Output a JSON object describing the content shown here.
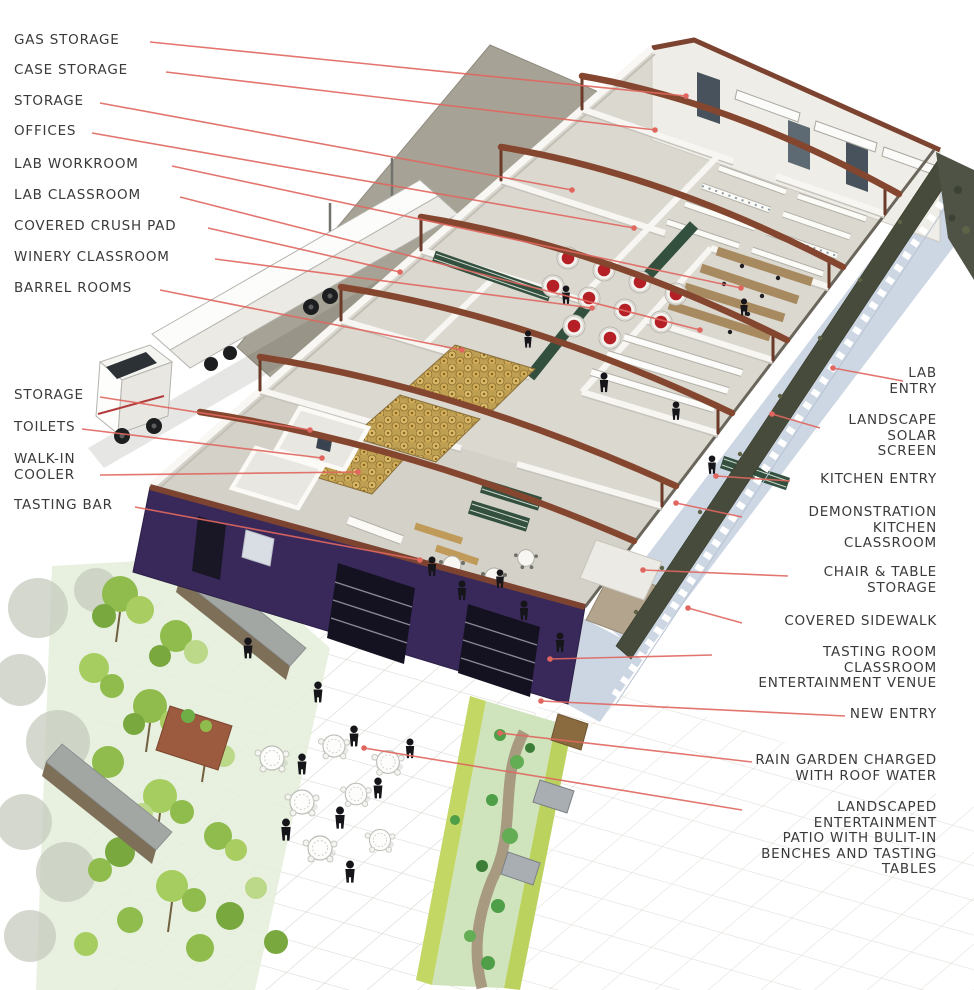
{
  "diagram": {
    "type": "architectural-cutaway-axonometric",
    "subject": "winery and culinary education building with labeled program areas"
  },
  "colors": {
    "leader": "#e0675f",
    "label_text": "#3a3a3a",
    "purple_wall": "#39295a",
    "beam_brown": "#84462e",
    "roof_trim": "#7c4430",
    "crush_pad_gray": "#a6a295",
    "sidewalk_blue": "#cdd7e4",
    "solar_screen": "#474b3c",
    "tank_top_red": "#b42026",
    "barrel_gold": "#c9a85c",
    "wine_rack_green": "#33503f",
    "tree_green": "#8fbc4d",
    "rain_garden_green": "#cfe3bd",
    "floor_gray": "#dbd8d0"
  },
  "left_labels": [
    {
      "id": "gas-storage",
      "lines": [
        "GAS STORAGE"
      ],
      "x": 14,
      "y": 33,
      "from": [
        150,
        42
      ],
      "to": [
        686,
        96
      ]
    },
    {
      "id": "case-storage",
      "lines": [
        "CASE STORAGE"
      ],
      "x": 14,
      "y": 63,
      "from": [
        166,
        72
      ],
      "to": [
        655,
        130
      ]
    },
    {
      "id": "storage-upper",
      "lines": [
        "STORAGE"
      ],
      "x": 14,
      "y": 94,
      "from": [
        100,
        103
      ],
      "to": [
        572,
        190
      ]
    },
    {
      "id": "offices",
      "lines": [
        "OFFICES"
      ],
      "x": 14,
      "y": 124,
      "from": [
        92,
        133
      ],
      "to": [
        634,
        228
      ]
    },
    {
      "id": "lab-workroom",
      "lines": [
        "LAB WORKROOM"
      ],
      "x": 14,
      "y": 157,
      "from": [
        172,
        166
      ],
      "to": [
        741,
        288
      ]
    },
    {
      "id": "lab-classroom",
      "lines": [
        "LAB CLASSROOM"
      ],
      "x": 14,
      "y": 188,
      "from": [
        180,
        197
      ],
      "to": [
        700,
        330
      ]
    },
    {
      "id": "covered-crush-pad",
      "lines": [
        "COVERED CRUSH PAD"
      ],
      "x": 14,
      "y": 219,
      "from": [
        208,
        228
      ],
      "to": [
        400,
        272
      ]
    },
    {
      "id": "winery-classroom",
      "lines": [
        "WINERY CLASSROOM"
      ],
      "x": 14,
      "y": 250,
      "from": [
        215,
        259
      ],
      "to": [
        592,
        308
      ]
    },
    {
      "id": "barrel-rooms",
      "lines": [
        "BARREL ROOMS"
      ],
      "x": 14,
      "y": 281,
      "from": [
        160,
        290
      ],
      "to": [
        462,
        350
      ]
    },
    {
      "id": "storage-lower",
      "lines": [
        "STORAGE"
      ],
      "x": 14,
      "y": 388,
      "from": [
        100,
        397
      ],
      "to": [
        310,
        430
      ]
    },
    {
      "id": "toilets",
      "lines": [
        "TOILETS"
      ],
      "x": 14,
      "y": 420,
      "from": [
        82,
        429
      ],
      "to": [
        322,
        458
      ]
    },
    {
      "id": "walk-in-cooler",
      "lines": [
        "WALK-IN",
        "COOLER"
      ],
      "x": 14,
      "y": 452,
      "from": [
        100,
        475
      ],
      "to": [
        358,
        472
      ]
    },
    {
      "id": "tasting-bar",
      "lines": [
        "TASTING BAR"
      ],
      "x": 14,
      "y": 498,
      "from": [
        135,
        507
      ],
      "to": [
        420,
        560
      ]
    }
  ],
  "right_labels": [
    {
      "id": "lab-entry",
      "lines": [
        "LAB",
        "ENTRY"
      ],
      "xr": 937,
      "y": 366,
      "from": [
        903,
        381
      ],
      "to": [
        833,
        368
      ]
    },
    {
      "id": "landscape-solar-screen",
      "lines": [
        "LANDSCAPE",
        "SOLAR",
        "SCREEN"
      ],
      "xr": 937,
      "y": 413,
      "from": [
        820,
        428
      ],
      "to": [
        772,
        414
      ]
    },
    {
      "id": "kitchen-entry",
      "lines": [
        "KITCHEN ENTRY"
      ],
      "xr": 937,
      "y": 472,
      "from": [
        790,
        481
      ],
      "to": [
        716,
        476
      ]
    },
    {
      "id": "demonstration-kitchen-classroom",
      "lines": [
        "DEMONSTRATION",
        "KITCHEN",
        "CLASSROOM"
      ],
      "xr": 937,
      "y": 505,
      "from": [
        742,
        517
      ],
      "to": [
        676,
        503
      ]
    },
    {
      "id": "chair-table-storage",
      "lines": [
        "CHAIR & TABLE",
        "STORAGE"
      ],
      "xr": 937,
      "y": 565,
      "from": [
        788,
        576
      ],
      "to": [
        643,
        570
      ]
    },
    {
      "id": "covered-sidewalk",
      "lines": [
        "COVERED SIDEWALK"
      ],
      "xr": 937,
      "y": 614,
      "from": [
        742,
        623
      ],
      "to": [
        688,
        608
      ]
    },
    {
      "id": "tasting-room-venue",
      "lines": [
        "TASTING ROOM",
        "CLASSROOM",
        "ENTERTAINMENT VENUE"
      ],
      "xr": 937,
      "y": 645,
      "from": [
        712,
        655
      ],
      "to": [
        550,
        659
      ]
    },
    {
      "id": "new-entry",
      "lines": [
        "NEW ENTRY"
      ],
      "xr": 937,
      "y": 707,
      "from": [
        845,
        716
      ],
      "to": [
        541,
        701
      ]
    },
    {
      "id": "rain-garden",
      "lines": [
        "RAIN GARDEN CHARGED",
        "WITH ROOF WATER"
      ],
      "xr": 937,
      "y": 753,
      "from": [
        752,
        762
      ],
      "to": [
        500,
        733
      ]
    },
    {
      "id": "landscaped-patio",
      "lines": [
        "LANDSCAPED",
        "ENTERTAINMENT",
        "PATIO WITH BULIT-IN",
        "BENCHES AND TASTING",
        "TABLES"
      ],
      "xr": 937,
      "y": 800,
      "from": [
        742,
        810
      ],
      "to": [
        364,
        748
      ]
    }
  ]
}
